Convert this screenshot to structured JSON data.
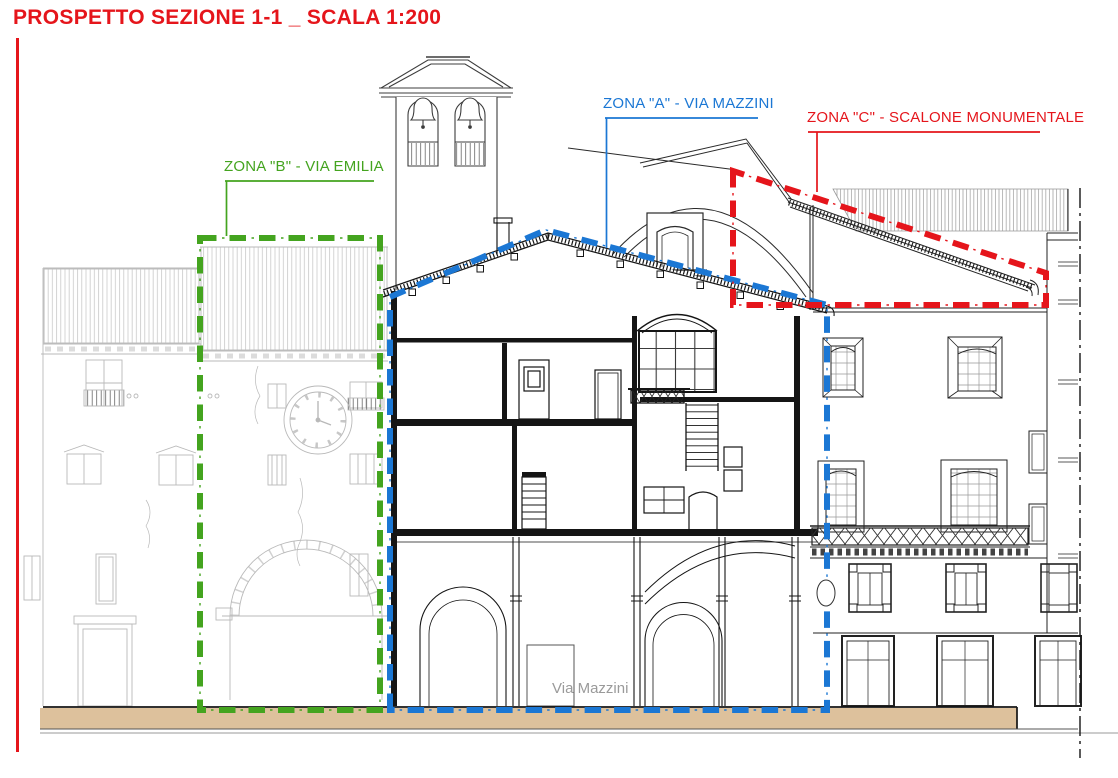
{
  "title": {
    "text": "PROSPETTO SEZIONE 1-1 _ SCALA 1:200",
    "color": "#e5151b"
  },
  "zones": {
    "b": {
      "label": "ZONA \"B\" - VIA EMILIA",
      "color": "#44a41f"
    },
    "a": {
      "label": "ZONA \"A\" - VIA MAZZINI",
      "color": "#1b77d4"
    },
    "c": {
      "label": "ZONA \"C\" - SCALONE MONUMENTALE",
      "color": "#e5151b"
    }
  },
  "street": {
    "label": "Via Mazzini",
    "color": "#9a9a9a"
  },
  "drawing": {
    "scale": "1:200",
    "ground_color": "#ddc19c",
    "background_line_color": "#b9b9b9",
    "section_line_color": "#151515"
  }
}
